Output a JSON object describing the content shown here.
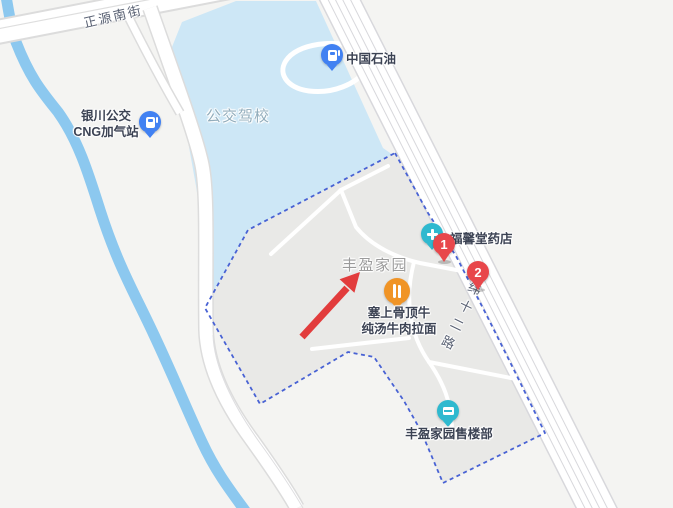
{
  "map": {
    "road_labels": {
      "zhengyuan_street": "正源南街",
      "weishier_road": "纬十二路"
    },
    "poi": {
      "petrochina": {
        "label": "中国石油"
      },
      "cng_station": {
        "line1": "银川公交",
        "line2": "CNG加气站"
      },
      "driving_school": {
        "label": "公交驾校"
      },
      "estate": {
        "label": "丰盈家园"
      },
      "pharmacy": {
        "label": "福馨堂药店"
      },
      "noodle_shop": {
        "line1": "塞上骨顶牛",
        "line2": "纯汤牛肉拉面"
      },
      "sales_office": {
        "label": "丰盈家园售楼部"
      }
    },
    "markers": [
      {
        "number": "1"
      },
      {
        "number": "2"
      }
    ],
    "colors": {
      "background": "#f4f4f2",
      "water": "#cde7f6",
      "canal": "#8cc8ef",
      "compound_fill": "#e9e9e7",
      "boundary_blue": "#4862d4",
      "poi_blue": "#4181f2",
      "poi_teal": "#2fb9cf",
      "poi_orange": "#f09426",
      "marker_red": "#e8474b",
      "arrow_red": "#e23c3c"
    }
  }
}
